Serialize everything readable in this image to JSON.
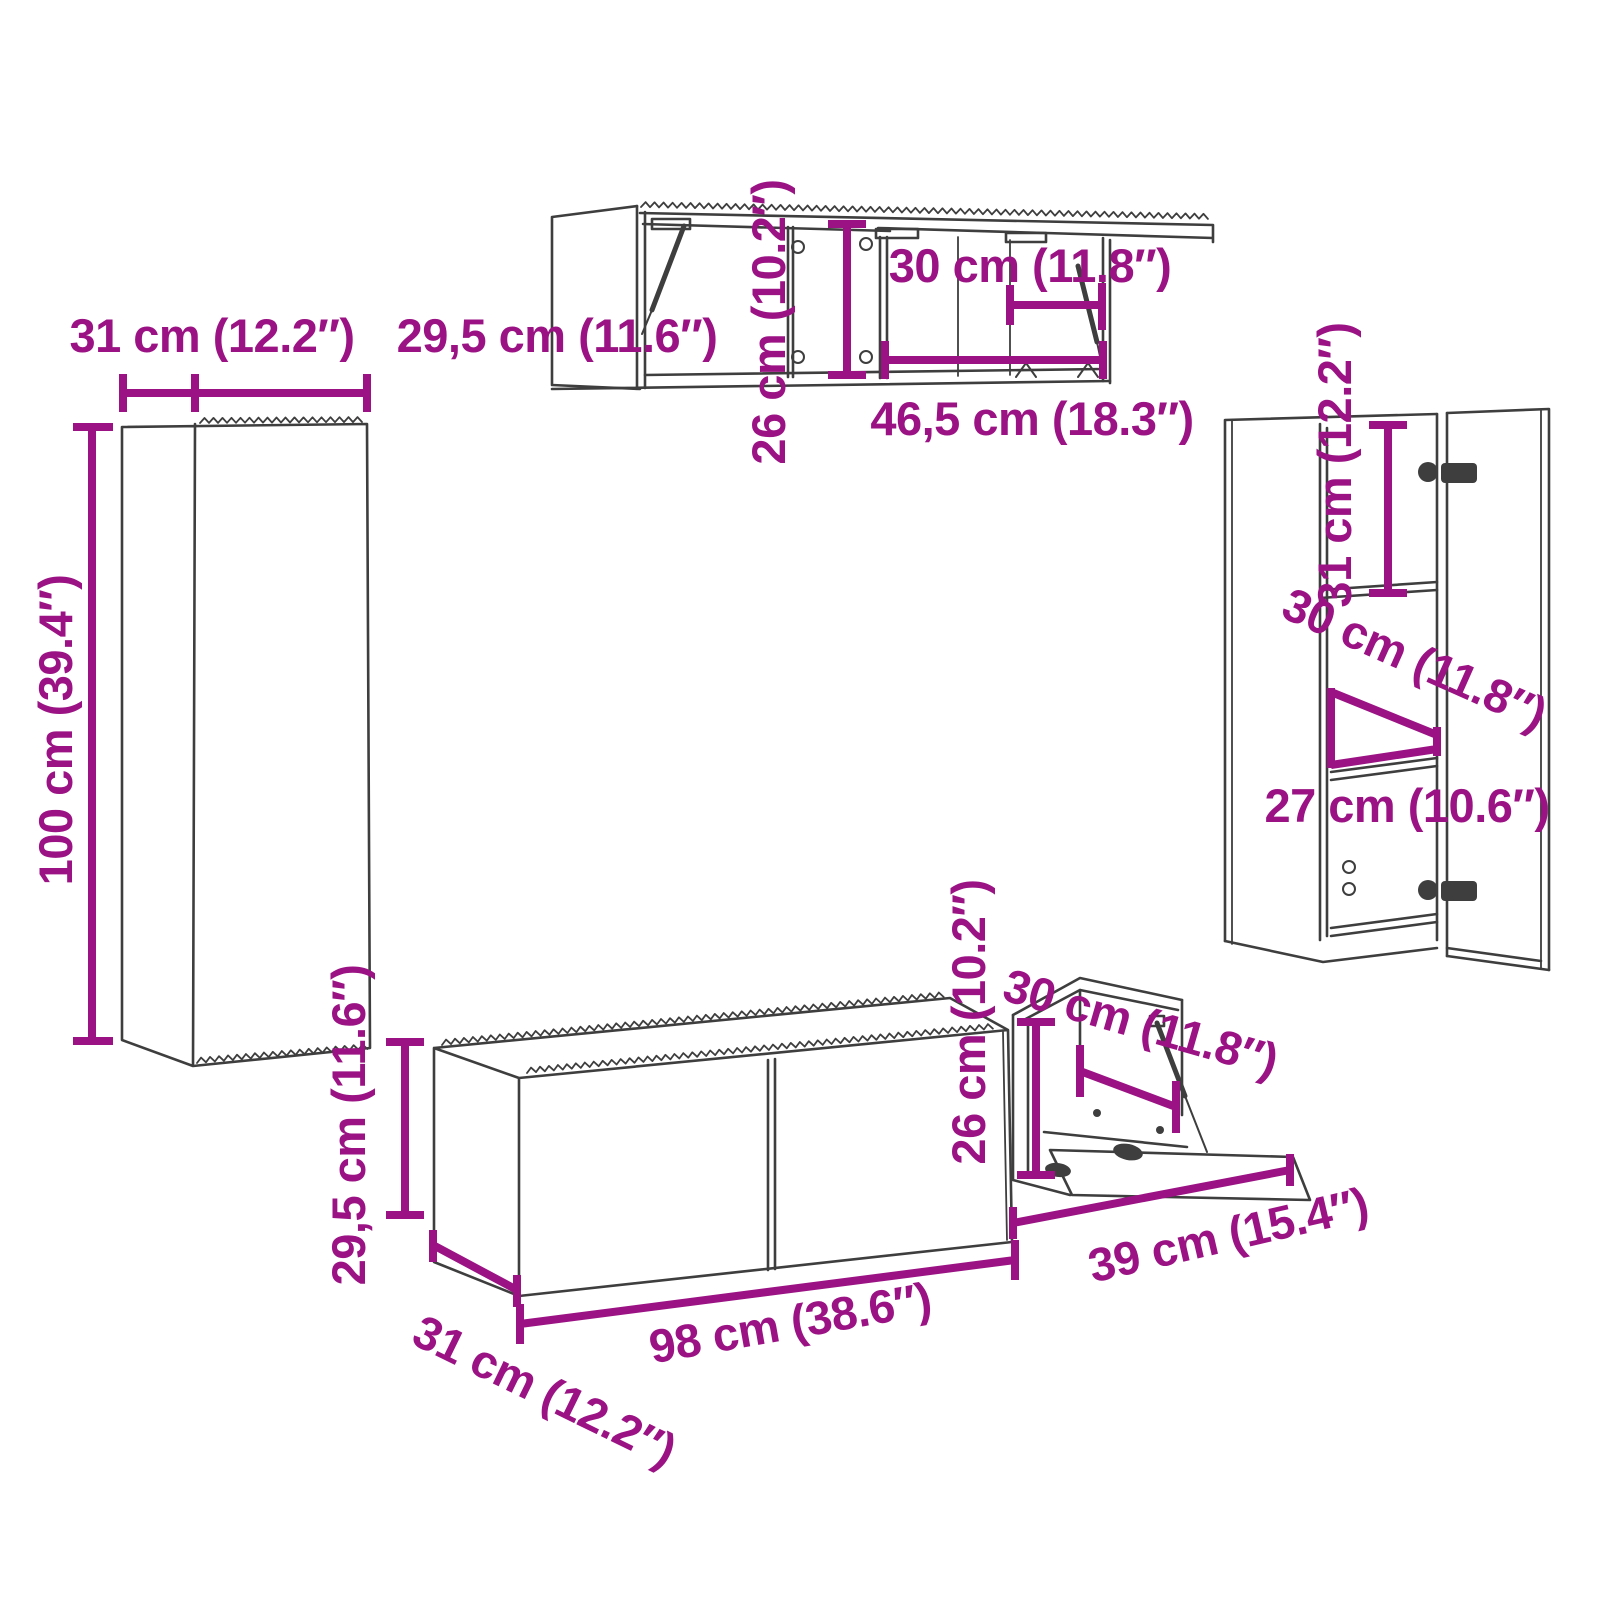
{
  "style": {
    "dimension_color": "#9A1283",
    "line_color": "#3E3E3E",
    "background": "#FFFFFF"
  },
  "diagram": {
    "kind": "furniture-dimension-diagram",
    "pieces_count": 5
  },
  "cabinets": {
    "left_tall": {
      "name": "tall wall cabinet (left)",
      "width": "31 cm (12.2″)",
      "depth": "29,5 cm (11.6″)",
      "height": "100 cm (39.4″)"
    },
    "top_wall": {
      "name": "horizontal wall cabinets with flip-up doors (top)",
      "height": "26 cm (10.2″)",
      "inner_width": "30 cm (11.8″)",
      "width": "46,5 cm (18.3″)"
    },
    "right_tall": {
      "name": "tall wall cabinet with open door (right)",
      "upper_height": "31 cm (12.2″)",
      "depth": "30 cm (11.8″)",
      "lower_height": "27 cm (10.6″)"
    },
    "tv_bench": {
      "name": "TV bench with two doors (bottom)",
      "height": "29,5 cm (11.6″)",
      "depth": "31 cm (12.2″)",
      "width": "98 cm (38.6″)"
    },
    "flap_cabinet": {
      "name": "wall cabinet with open flap door (bottom right)",
      "height": "26 cm (10.2″)",
      "depth": "30 cm (11.8″)",
      "width": "39 cm (15.4″)"
    }
  }
}
